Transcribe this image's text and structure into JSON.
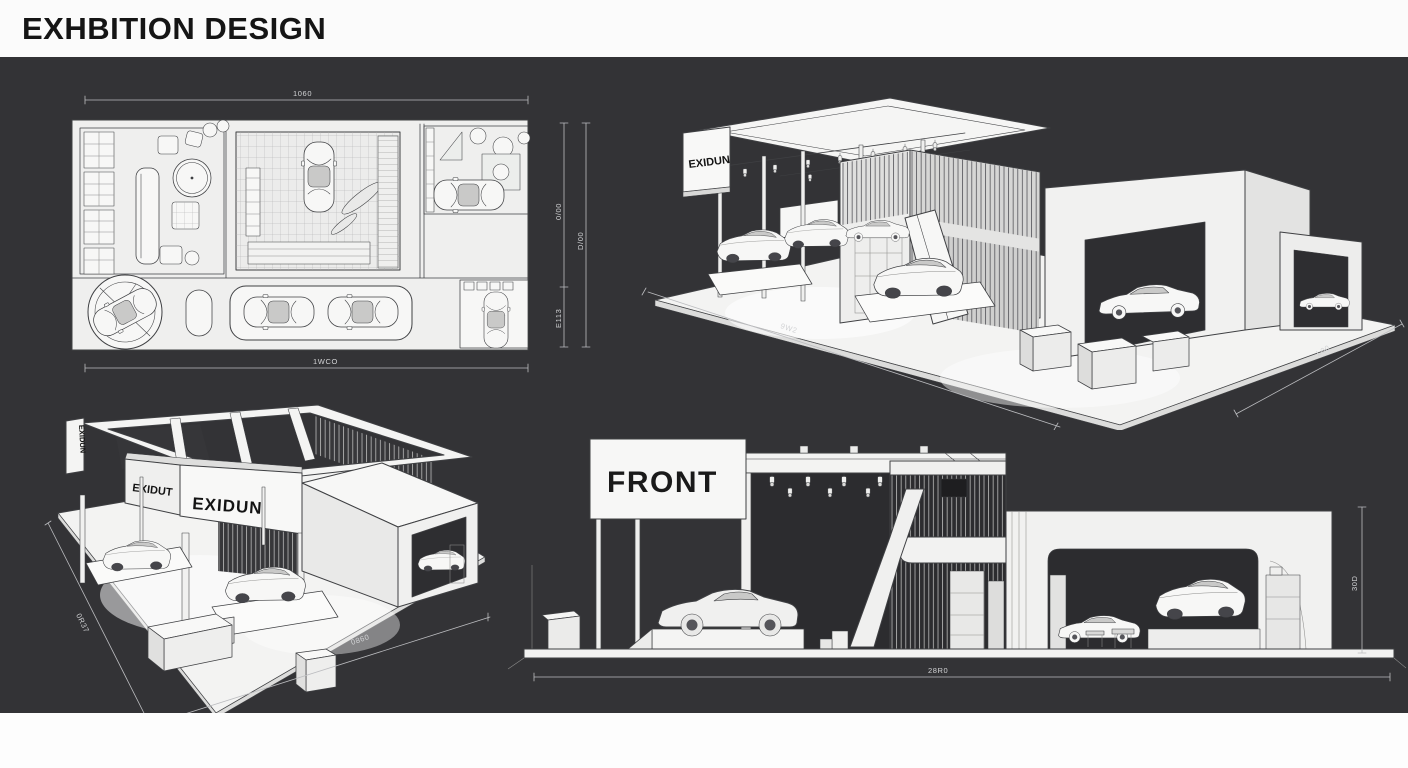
{
  "header": {
    "title": "EXHBITION DESIGN"
  },
  "colors": {
    "background": "#333336",
    "header_bg": "#fbfbfb",
    "header_text": "#151515",
    "paper": "#efefee",
    "line": "#3f4043",
    "dim_line": "#bcbdc0",
    "interior_dark": "#2c2c2f"
  },
  "plan": {
    "dim_top": "1060",
    "dim_bottom": "1WCO",
    "dim_right_inner_top": "0/00",
    "dim_right_inner_bottom": "E113",
    "dim_right_outer": "D/00"
  },
  "iso_top": {
    "sign": "EXIDUN",
    "dim_left": "9W2",
    "dim_right": "L00"
  },
  "iso_bottom": {
    "sign_side": "EXIDUN",
    "sign_left": "EXIDUT",
    "sign_right": "EXIDUN",
    "dim_left": "0R37",
    "dim_bottom": "0860"
  },
  "front": {
    "sign": "FRONT",
    "dim_bottom": "28R0",
    "dim_right": "30D"
  }
}
